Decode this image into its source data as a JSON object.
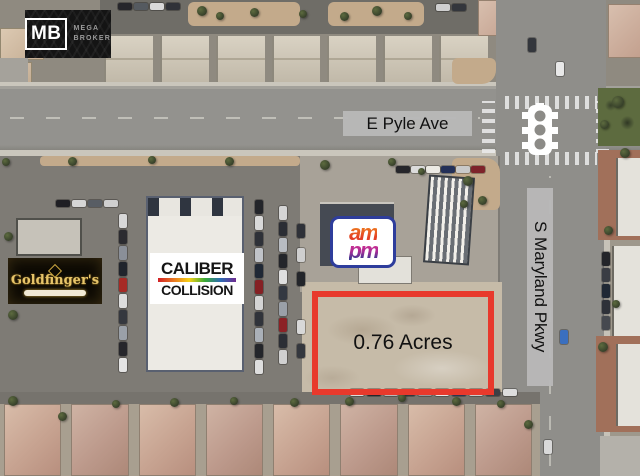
{
  "map": {
    "street_labels": {
      "e_pyle": "E Pyle Ave",
      "s_maryland": "S Maryland Pkwy"
    },
    "parcel": {
      "area_label": "0.76 Acres",
      "outline_color": "#e8392c"
    },
    "logos": {
      "mega_broker": {
        "monogram": "MB",
        "name_line1": "MEGA",
        "name_line2": "BROKER"
      },
      "goldfingers": {
        "name": "Goldfinger's"
      },
      "caliber_collision": {
        "line1": "CALIBER",
        "line2": "COLLISION"
      },
      "ampm": {
        "top": "am",
        "bottom": "pm"
      }
    },
    "icons": {
      "traffic_light": "traffic-light-icon"
    },
    "colors": {
      "street_label_bg": "#b8b8b8",
      "gold_accent": "#e7c56a",
      "ampm_border": "#2e3d9c"
    }
  }
}
